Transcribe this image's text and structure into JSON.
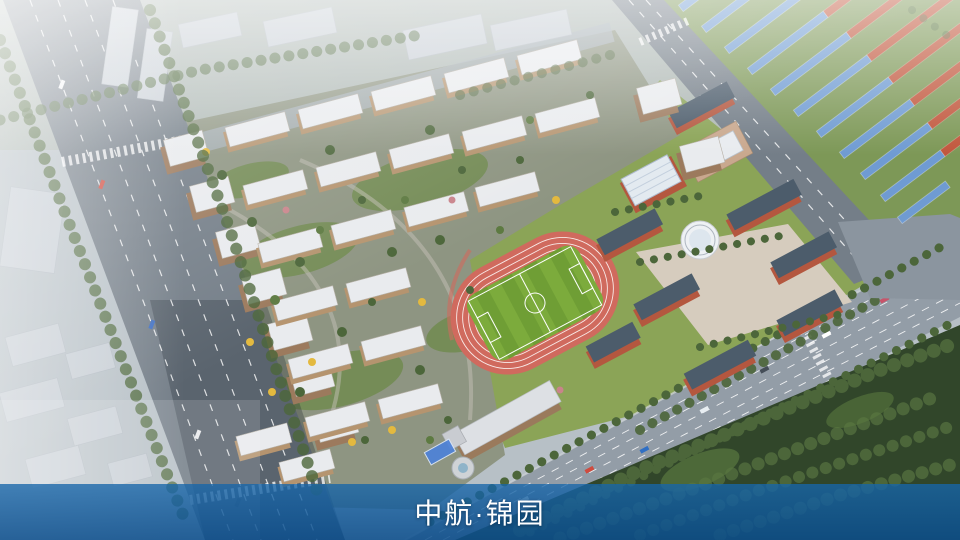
{
  "banner": {
    "title": "中航·锦园"
  },
  "colors": {
    "banner": "#1264a8",
    "banner_text": "#ffffff",
    "road": "#747e88",
    "avenue": "#939da7",
    "resi_roof": "#e9ebee",
    "resi_wall": "#b5946f",
    "tower_wall": "#9c7a5d",
    "school_wall": "#b4573f",
    "school_roof": "#4c5c6b",
    "plaza": "#d6ccbe",
    "track": "#d06a5e",
    "field_green": "#7cab3c",
    "field_stripe": "#6f9e35",
    "townhouse_blue": "#6f9bd2",
    "townhouse_red": "#c1563c",
    "townhouse_ground": "#7d9857",
    "tree_green": "#4c663a",
    "tree_yellow": "#e3b93f",
    "forest": "#31462a",
    "context": "#c6cdd4"
  }
}
